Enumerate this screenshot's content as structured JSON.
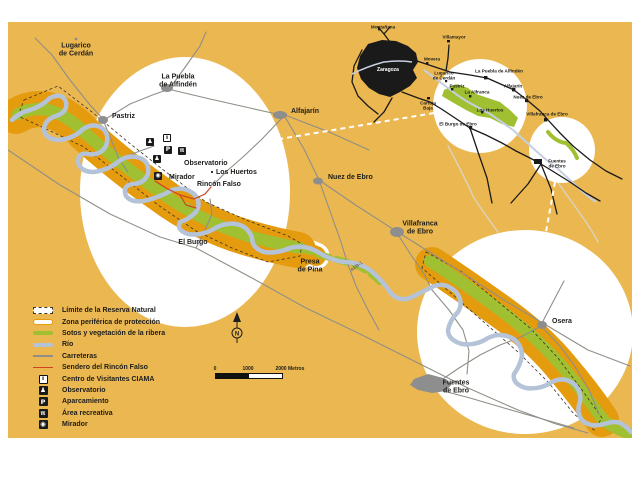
{
  "colors": {
    "background": "#EBB750",
    "protection_zone": "#E59B0E",
    "vegetation": "#A0C032",
    "river": "#B4C3D7",
    "roads": "#8F8F88",
    "towns": "#8E8E8E",
    "trail": "#CC4422",
    "inset_roads": "#1a1a1a"
  },
  "north": {
    "label": "N"
  },
  "scale": {
    "ticks": [
      "0",
      "1000",
      "2000"
    ],
    "unit": "Metros"
  },
  "icon_glyphs": {
    "info": "i",
    "observatory": "♟",
    "parking": "P",
    "area": "π",
    "mirador": "◉"
  },
  "legend": {
    "items": [
      {
        "label": "Límite de la Reserva Natural",
        "swatch": "limite"
      },
      {
        "label": "Zona periférica de protección",
        "swatch": "zona"
      },
      {
        "label": "Sotos y vegetación de la ribera",
        "swatch": "sotos"
      },
      {
        "label": "Río",
        "swatch": "rio"
      },
      {
        "label": "Carreteras",
        "swatch": "carreteras"
      },
      {
        "label": "Sendero del Rincón Falso",
        "swatch": "sendero"
      },
      {
        "label": "Centro de Visitantes CIAMA",
        "swatch": "icon",
        "icon": "info"
      },
      {
        "label": "Observatorio",
        "swatch": "icon",
        "icon": "observatory"
      },
      {
        "label": "Aparcamiento",
        "swatch": "icon",
        "icon": "parking"
      },
      {
        "label": "Área recreativa",
        "swatch": "icon",
        "icon": "area"
      },
      {
        "label": "Mirador",
        "swatch": "icon",
        "icon": "mirador"
      }
    ]
  },
  "map_labels": [
    {
      "id": "lugarico",
      "text": "Lugarico\nde Cerdán",
      "x": 76,
      "y": 50,
      "center": true
    },
    {
      "id": "la-puebla",
      "text": "La Puebla\nde Alfindén",
      "x": 178,
      "y": 81,
      "center": true
    },
    {
      "id": "pastriz",
      "text": "Pastriz",
      "x": 112,
      "y": 113
    },
    {
      "id": "alfajarin",
      "text": "Alfajarín",
      "x": 291,
      "y": 108
    },
    {
      "id": "nuez-de-ebro",
      "text": "Nuez de Ebro",
      "x": 328,
      "y": 174
    },
    {
      "id": "villafranca-de-ebro",
      "text": "Villafranca\nde Ebro",
      "x": 420,
      "y": 228,
      "center": true
    },
    {
      "id": "el-burgo",
      "text": "El Burgo",
      "x": 193,
      "y": 243,
      "center": true
    },
    {
      "id": "presa-de-pina",
      "text": "Presa\nde Pina",
      "x": 310,
      "y": 266,
      "center": true
    },
    {
      "id": "osera",
      "text": "Osera",
      "x": 552,
      "y": 318
    },
    {
      "id": "fuentes-de-ebro",
      "text": "Fuentes\nde Ebro",
      "x": 456,
      "y": 387,
      "center": true
    },
    {
      "id": "observatorio",
      "text": "Observatorio",
      "x": 184,
      "y": 160
    },
    {
      "id": "los-huertos",
      "text": "Los Huertos",
      "x": 216,
      "y": 169
    },
    {
      "id": "mirador",
      "text": "Mirador",
      "x": 169,
      "y": 174
    },
    {
      "id": "rincon-falso",
      "text": "Rincón Falso",
      "x": 197,
      "y": 181
    },
    {
      "id": "road-aeb1",
      "text": "AEB-1",
      "x": 357,
      "y": 267,
      "center": true,
      "rotate": -38,
      "size": "road"
    }
  ],
  "inset": {
    "city_label": "Zaragoza",
    "labels": [
      {
        "id": "montanana",
        "text": "Montañana",
        "x": 383,
        "y": 27,
        "center": true
      },
      {
        "id": "villamayor",
        "text": "Villamayor",
        "x": 454,
        "y": 37,
        "center": true
      },
      {
        "id": "movera",
        "text": "Movera",
        "x": 432,
        "y": 59,
        "center": true
      },
      {
        "id": "lugarico-inset",
        "text": "Lugarico\nde Cerdán",
        "x": 444,
        "y": 76,
        "center": true
      },
      {
        "id": "pastriz-inset",
        "text": "Pastriz",
        "x": 457,
        "y": 86,
        "center": true
      },
      {
        "id": "la-puebla-inset",
        "text": "La Puebla de Alfindén",
        "x": 499,
        "y": 71,
        "center": true
      },
      {
        "id": "alfajarin-inset",
        "text": "Alfajarín",
        "x": 513,
        "y": 86,
        "center": true
      },
      {
        "id": "la-alfranca-inset",
        "text": "La Alfranca",
        "x": 477,
        "y": 92,
        "center": true
      },
      {
        "id": "nuez-inset",
        "text": "Nuez de Ebro",
        "x": 528,
        "y": 97,
        "center": true
      },
      {
        "id": "los-huertos-inset",
        "text": "Los Huertos",
        "x": 490,
        "y": 110,
        "center": true
      },
      {
        "id": "villafranca-inset",
        "text": "Villafranca de Ebro",
        "x": 547,
        "y": 114,
        "center": true
      },
      {
        "id": "el-burgo-inset",
        "text": "El Burgo de Ebro",
        "x": 458,
        "y": 124,
        "center": true
      },
      {
        "id": "cartuja-baja",
        "text": "Cartuja\nBaja",
        "x": 428,
        "y": 106,
        "center": true
      },
      {
        "id": "fuentes-inset",
        "text": "Fuentes\nde Ebro",
        "x": 557,
        "y": 164,
        "center": true
      }
    ]
  },
  "facilities": [
    {
      "type": "observatory",
      "x": 146,
      "y": 138
    },
    {
      "type": "info",
      "x": 163,
      "y": 134
    },
    {
      "type": "parking",
      "x": 164,
      "y": 146
    },
    {
      "type": "area",
      "x": 178,
      "y": 147
    },
    {
      "type": "observatory",
      "x": 153,
      "y": 155
    },
    {
      "type": "mirador",
      "x": 154,
      "y": 172
    }
  ]
}
